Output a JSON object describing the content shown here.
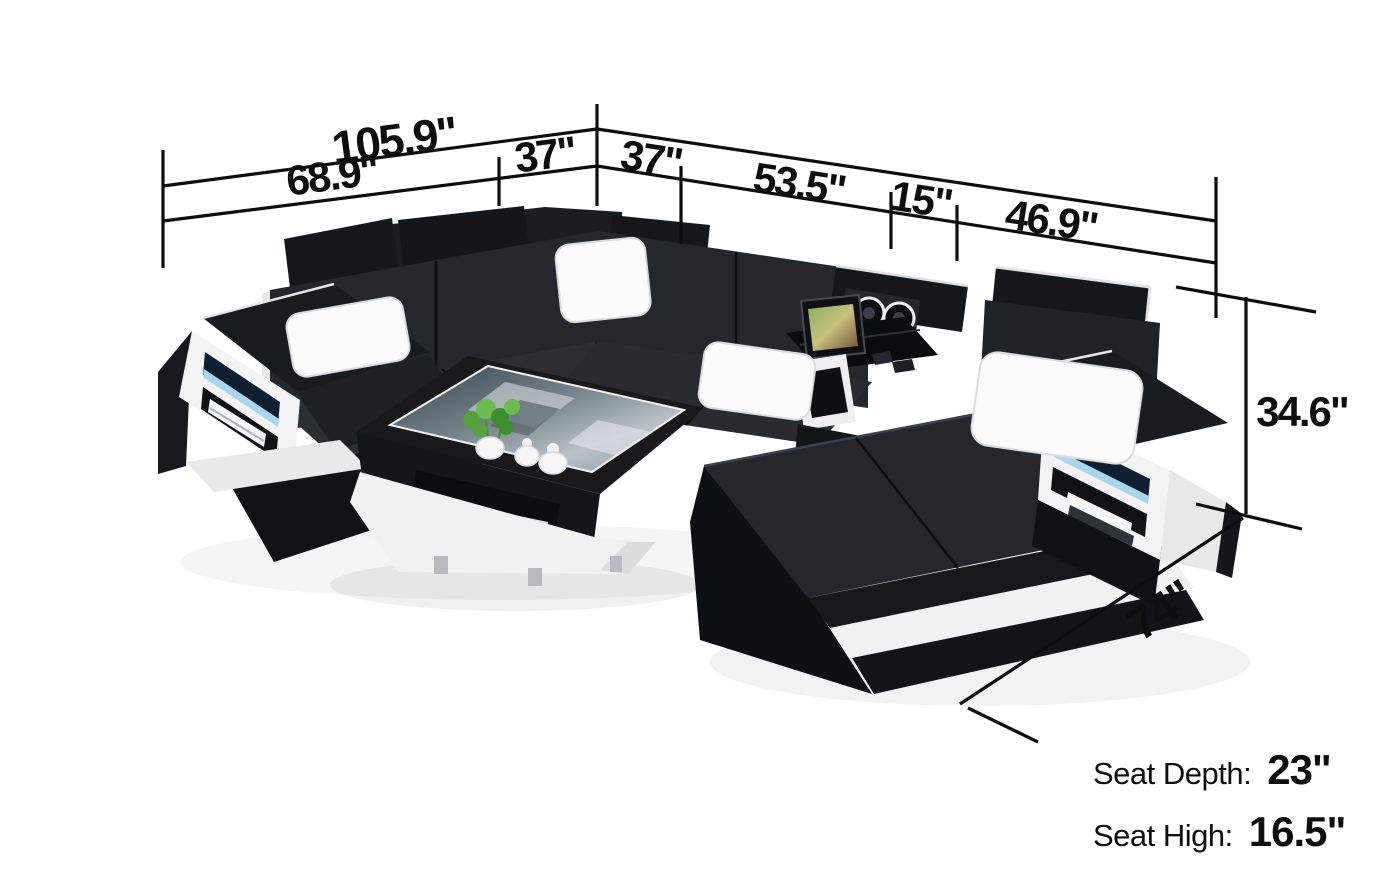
{
  "dims": {
    "overall_width": "105.9\"",
    "left_section_width": "68.9\"",
    "left_corner_width": "37\"",
    "right_corner_width": "37\"",
    "right_section_width": "53.5\"",
    "console_width": "15\"",
    "chaise_section_width": "46.9\"",
    "back_height": "34.6\"",
    "chaise_length": "74\""
  },
  "specs": {
    "seat_depth_label": "Seat Depth:",
    "seat_depth_value": "23\"",
    "seat_height_label": "Seat High:",
    "seat_height_value": "16.5\""
  },
  "colors": {
    "background": "#ffffff",
    "sofa_leather_dark": "#16181b",
    "sofa_leather_mid": "#24272b",
    "trim_white": "#f2f2f2",
    "led_glow_blue": "#a9d8ee",
    "dimension_line": "#0d0d0d",
    "glass_reflection": "#8d979e",
    "plant_green": "#55a23c",
    "chrome_feet": "#b7bbc0"
  }
}
